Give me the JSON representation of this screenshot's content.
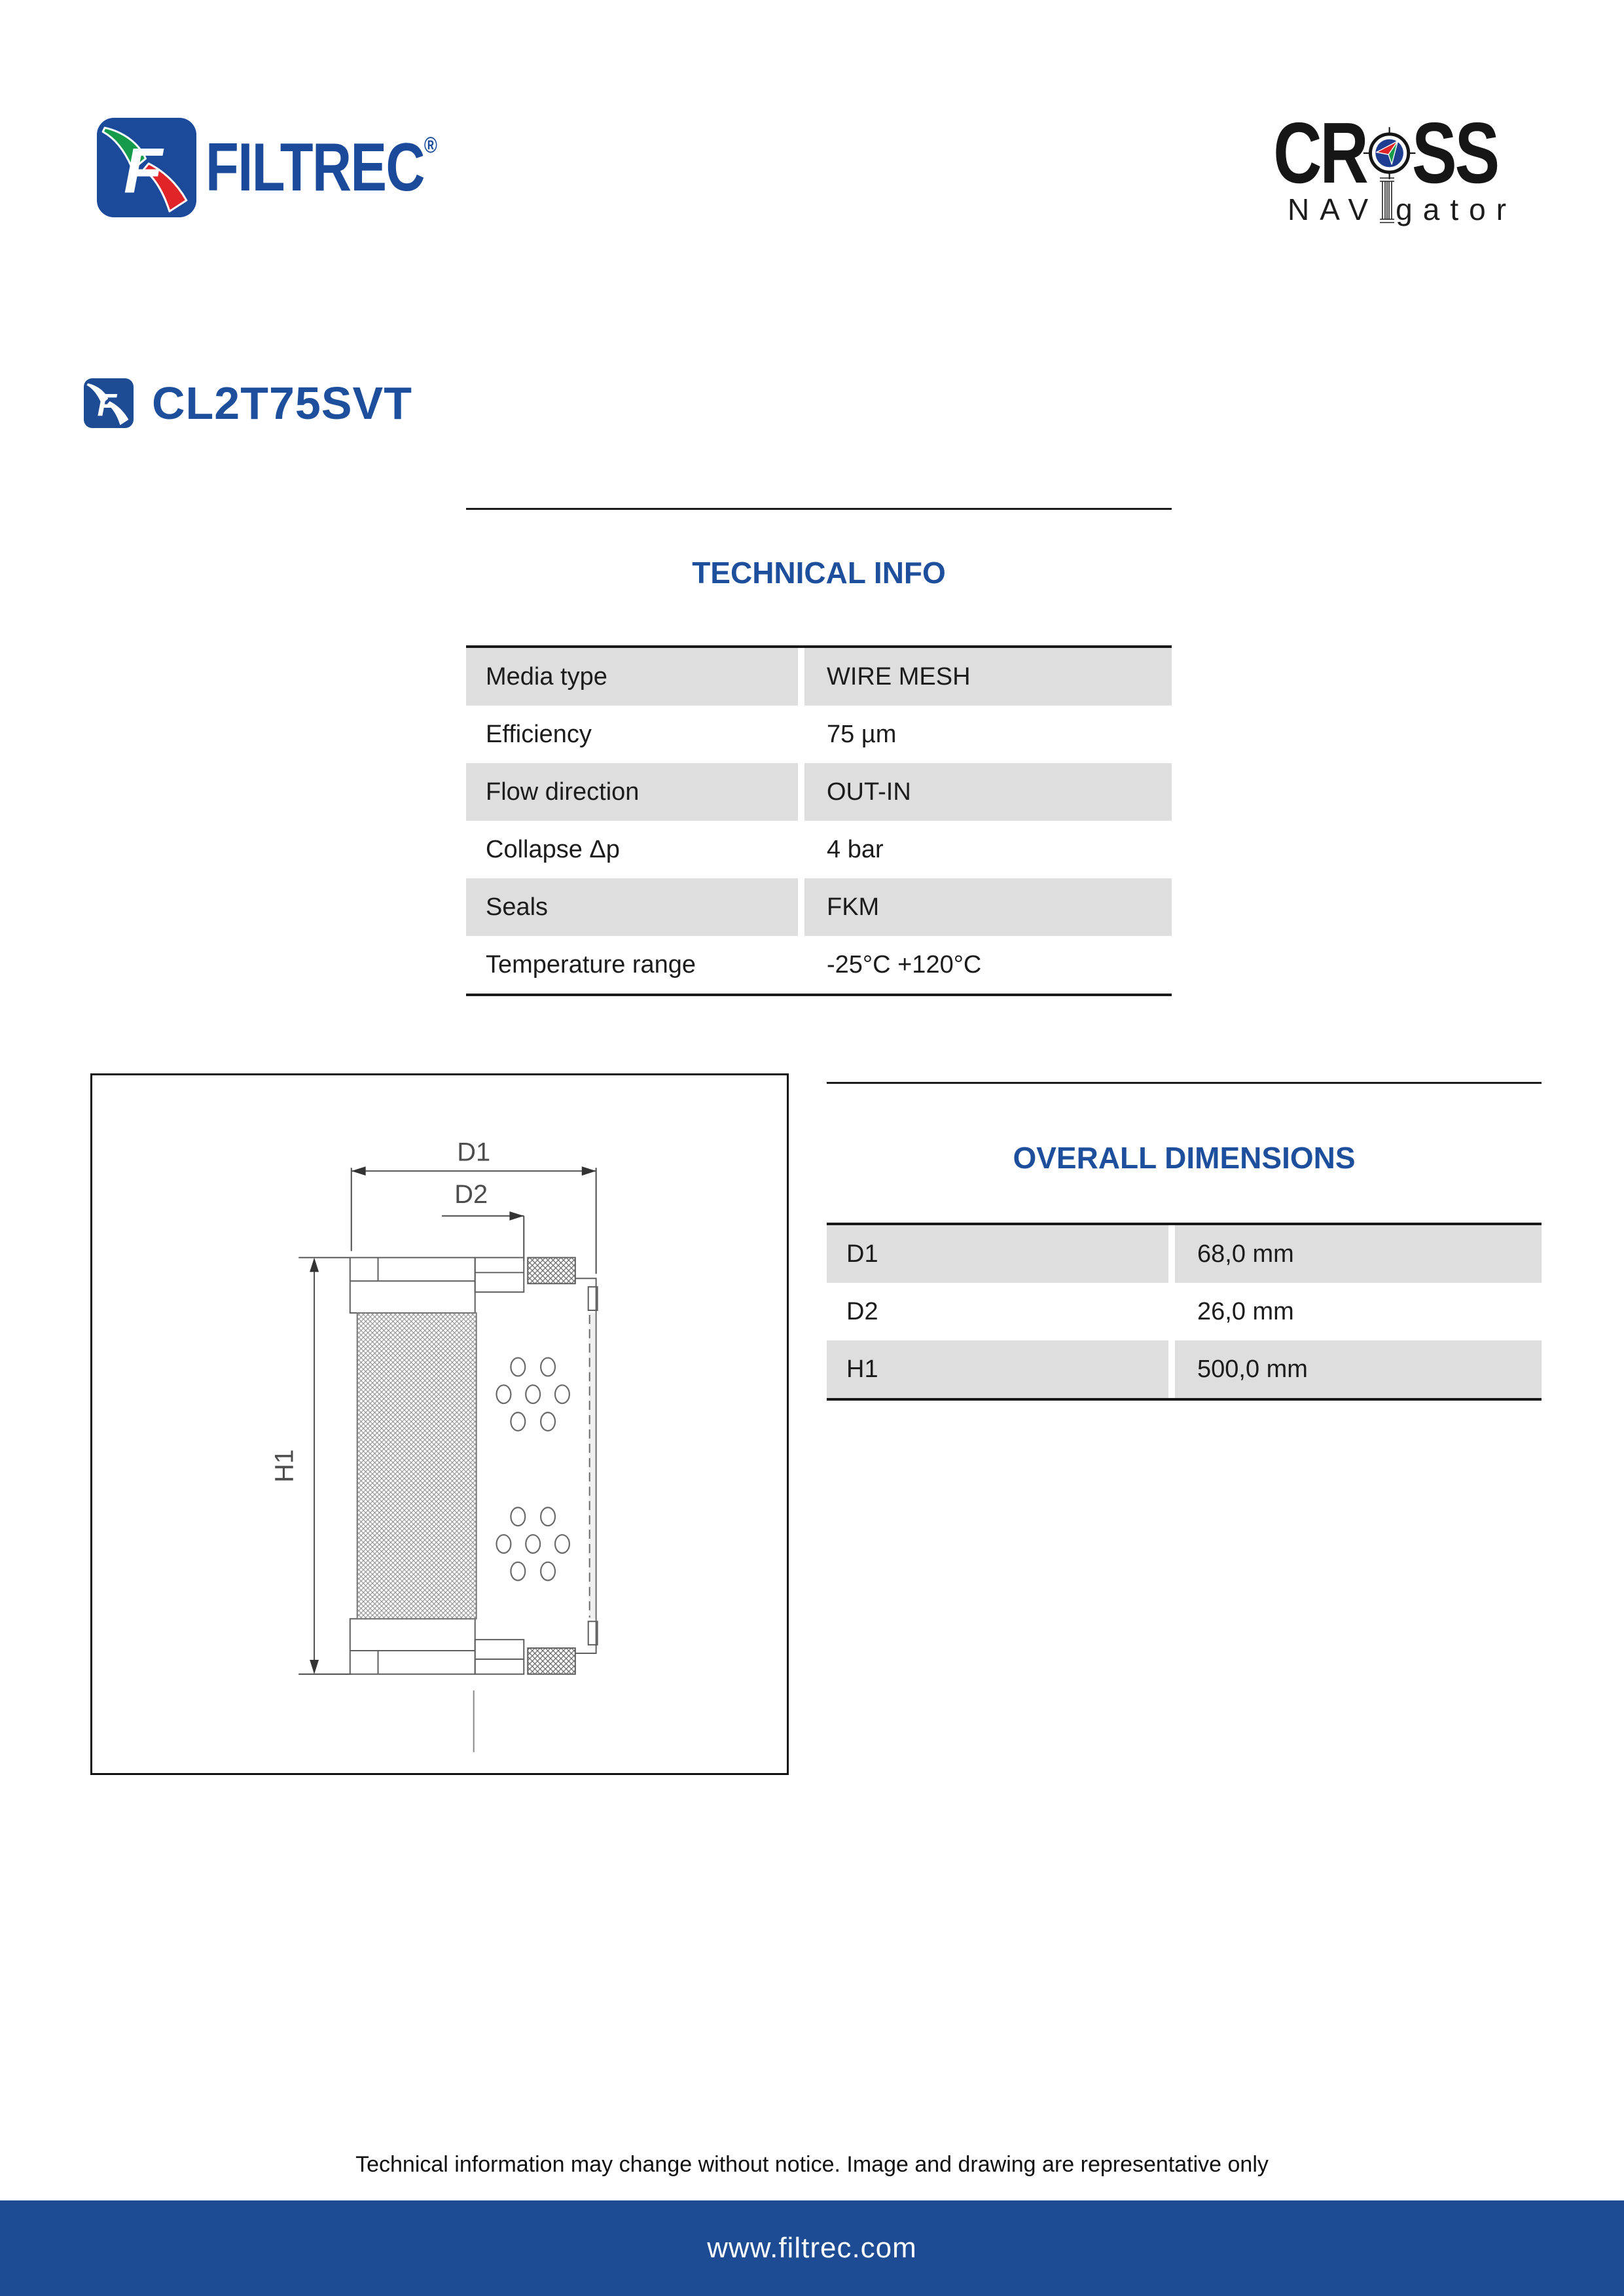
{
  "header": {
    "filtrec_wordmark": "FILTREC",
    "registered_mark": "®",
    "cross_line1_left": "CR",
    "cross_line1_right": "SS",
    "cross_line2_nav": "NAV",
    "cross_line2_gator": "gator"
  },
  "product": {
    "code": "CL2T75SVT"
  },
  "technical_info": {
    "title": "TECHNICAL INFO",
    "rows": [
      {
        "label": "Media type",
        "value": "WIRE MESH"
      },
      {
        "label": "Efficiency",
        "value": "75 µm"
      },
      {
        "label": "Flow direction",
        "value": "OUT-IN"
      },
      {
        "label": "Collapse Δp",
        "value": "4 bar"
      },
      {
        "label": "Seals",
        "value": "FKM"
      },
      {
        "label": "Temperature range",
        "value": "-25°C +120°C"
      }
    ]
  },
  "overall_dimensions": {
    "title": "OVERALL DIMENSIONS",
    "rows": [
      {
        "label": "D1",
        "value": "68,0 mm"
      },
      {
        "label": "D2",
        "value": "26,0 mm"
      },
      {
        "label": "H1",
        "value": "500,0 mm"
      }
    ]
  },
  "drawing": {
    "d1_label": "D1",
    "d2_label": "D2",
    "h1_label": "H1"
  },
  "footer": {
    "disclaimer": "Technical information may change without notice. Image and drawing are representative only",
    "website": "www.filtrec.com"
  },
  "colors": {
    "brand_blue": "#1e4f9c",
    "logo_blue": "#1b4a9b",
    "footer_blue": "#1d4b94",
    "table_row_gray": "#dddedd"
  }
}
